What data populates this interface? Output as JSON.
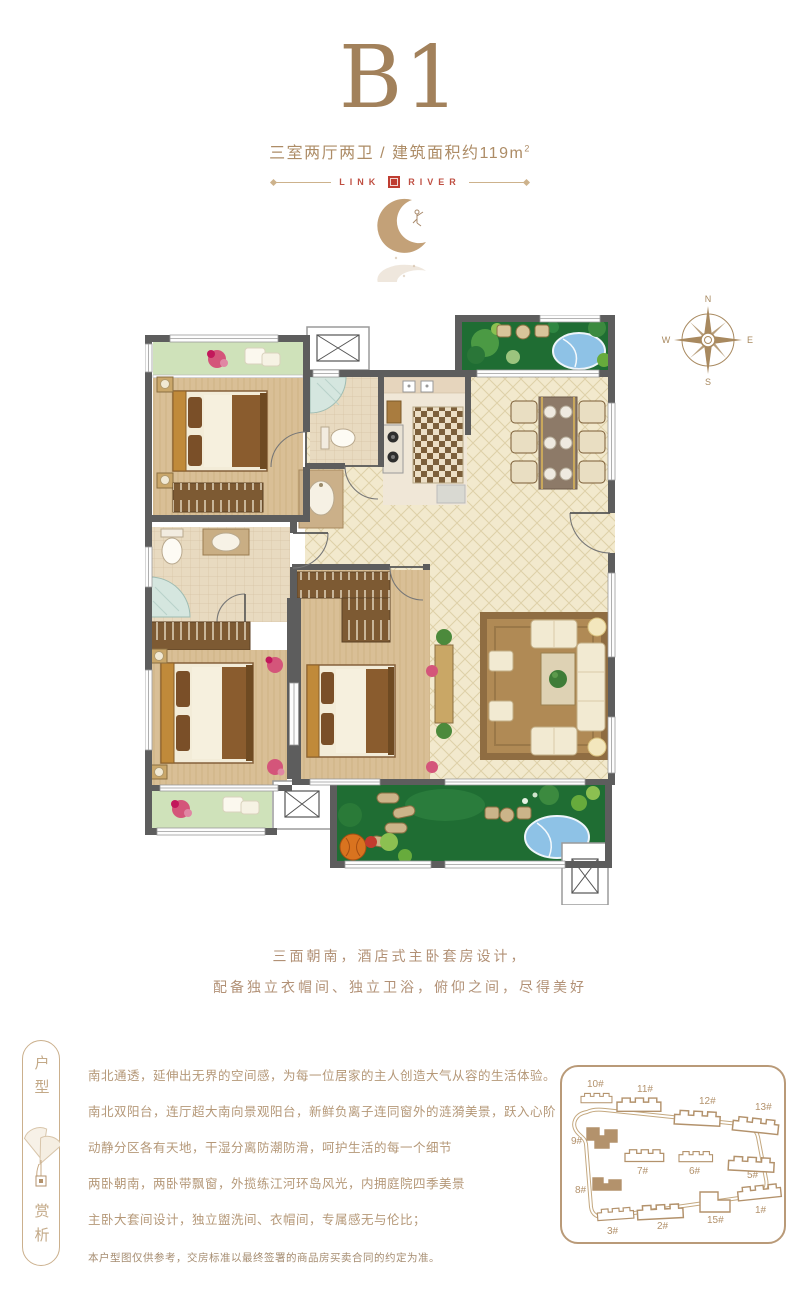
{
  "header": {
    "title": "B1",
    "subtitle": "三室两厅两卫 / 建筑面积约119m",
    "subtitle_sup": "2",
    "brand_left": "LINK",
    "brand_right": "RIVER"
  },
  "compass": {
    "n": "N",
    "e": "E",
    "s": "S",
    "w": "W"
  },
  "slogan": {
    "line1": "三面朝南，酒店式主卧套房设计，",
    "line2": "配备独立衣帽间、独立卫浴，俯仰之间，尽得美好"
  },
  "badge": {
    "top": "户型",
    "bottom": "赏析"
  },
  "description": {
    "lines": [
      "南北通透，延伸出无界的空间感，为每一位居家的主人创造大气从容的生活体验。",
      "南北双阳台，连厅超大南向景观阳台，新鲜负离子连同窗外的涟漪美景，跃入心阶",
      "动静分区各有天地，干湿分离防潮防滑，呵护生活的每一个细节",
      "两卧朝南，两卧带飘窗，外揽练江河环岛风光，内拥庭院四季美景",
      "主卧大套间设计，独立盥洗间、衣帽间，专属感无与伦比；"
    ],
    "disclaimer": "本户型图仅供参考，交房标准以最终签署的商品房买卖合同的约定为准。"
  },
  "site_map": {
    "buildings": [
      {
        "label": "10#",
        "highlighted": false
      },
      {
        "label": "11#",
        "highlighted": false
      },
      {
        "label": "12#",
        "highlighted": false
      },
      {
        "label": "13#",
        "highlighted": false
      },
      {
        "label": "9#",
        "highlighted": true
      },
      {
        "label": "7#",
        "highlighted": false
      },
      {
        "label": "6#",
        "highlighted": false
      },
      {
        "label": "5#",
        "highlighted": false
      },
      {
        "label": "8#",
        "highlighted": true
      },
      {
        "label": "3#",
        "highlighted": false
      },
      {
        "label": "2#",
        "highlighted": false
      },
      {
        "label": "15#",
        "highlighted": false
      },
      {
        "label": "1#",
        "highlighted": false
      }
    ]
  },
  "colors": {
    "accent": "#a2815b",
    "brand_red": "#bf4f42",
    "wall": "#5d5d5d"
  }
}
